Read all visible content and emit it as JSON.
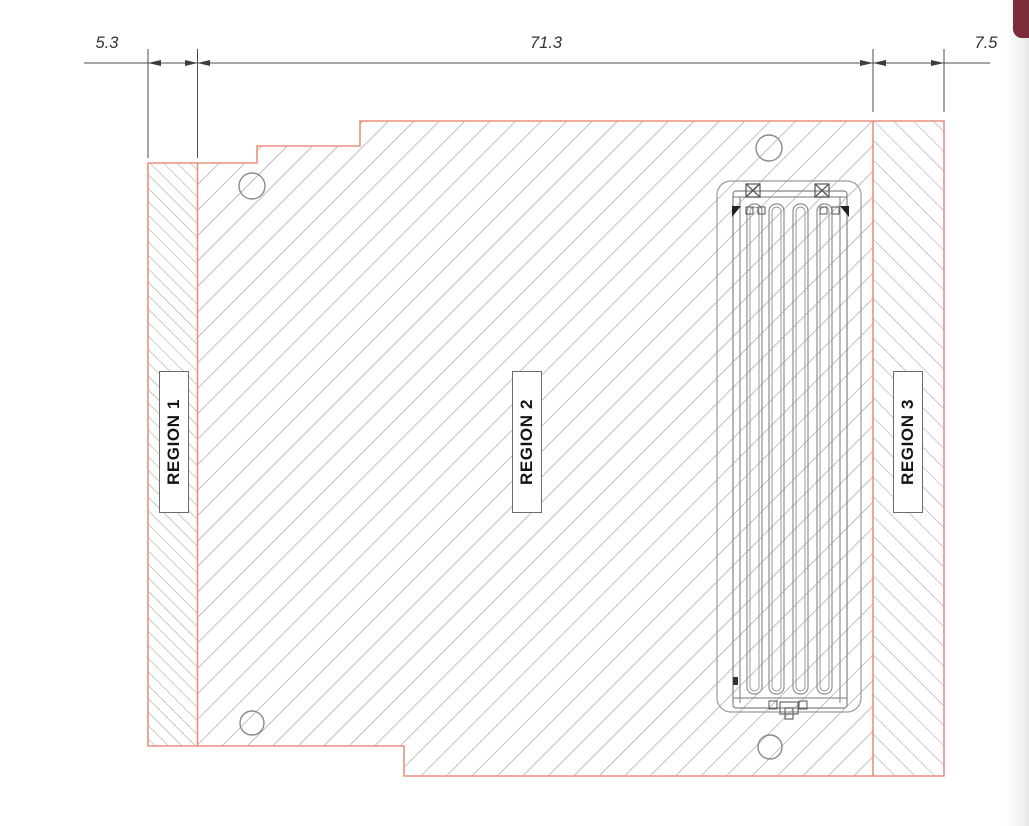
{
  "drawing": {
    "dimensions": [
      {
        "name": "region-1-width",
        "label": "5.3"
      },
      {
        "name": "region-2-width",
        "label": "71.3"
      },
      {
        "name": "region-3-width",
        "label": "7.5"
      }
    ],
    "regions": [
      {
        "label": "REGION 1"
      },
      {
        "label": "REGION 2"
      },
      {
        "label": "REGION 3"
      }
    ],
    "colors": {
      "part_outline": "#e9907e",
      "hatch_lines": "#a2a2a2",
      "dimension_lines": "#4d4d4d",
      "dimension_text": "#333333",
      "detail_lines": "#8f8f8f",
      "corner_badge": "#7b2d3b"
    }
  }
}
